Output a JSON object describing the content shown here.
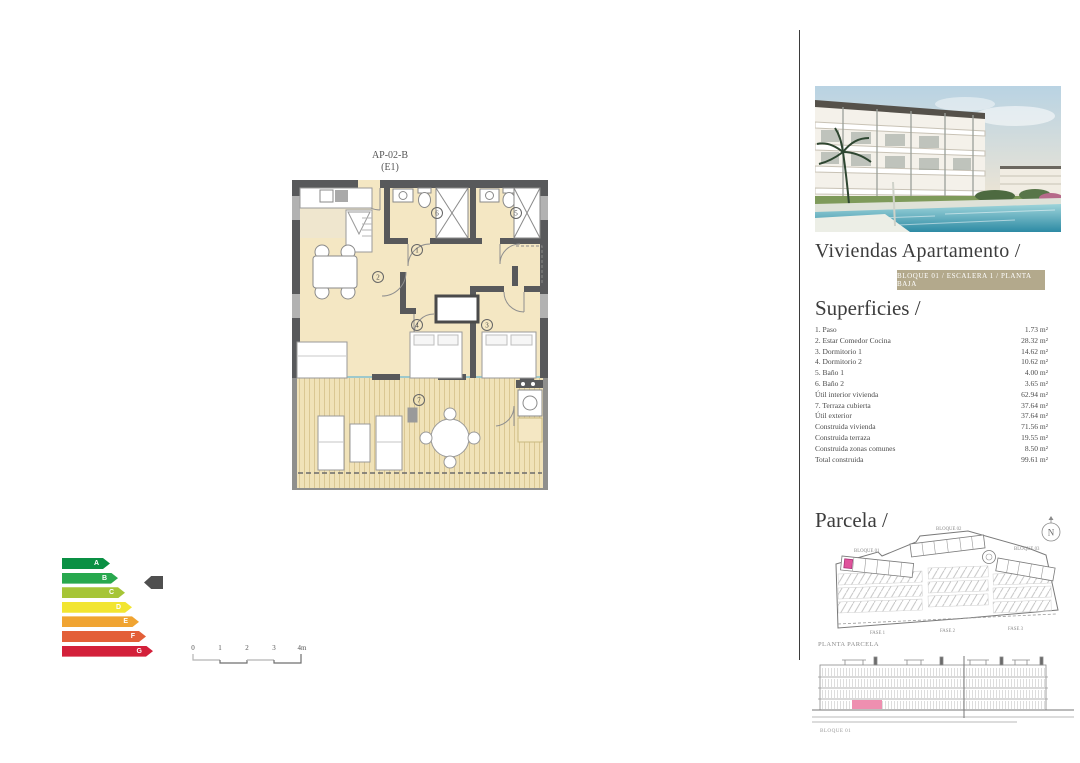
{
  "floorplan": {
    "title": "AP-02-B",
    "subtitle": "(E1)",
    "rooms": [
      "1",
      "2",
      "3",
      "4",
      "5",
      "6",
      "7"
    ]
  },
  "energy": {
    "ratings": [
      {
        "label": "A",
        "color": "#0a9044"
      },
      {
        "label": "B",
        "color": "#28a84e"
      },
      {
        "label": "C",
        "color": "#a6c537"
      },
      {
        "label": "D",
        "color": "#f2e531"
      },
      {
        "label": "E",
        "color": "#f0a432"
      },
      {
        "label": "F",
        "color": "#e35f38"
      },
      {
        "label": "G",
        "color": "#d3203a"
      }
    ],
    "selected": "B",
    "pointer_color": "#4f4f4f"
  },
  "scale_bar": {
    "ticks": [
      "0",
      "1",
      "2",
      "3",
      "4m"
    ]
  },
  "right_panel": {
    "title": "Viviendas Apartamento /",
    "badge": "BLOQUE 01 / ESCALERA 1 / PLANTA BAJA",
    "superficies_heading": "Superficies /",
    "superficies_rows": [
      {
        "label": "1. Paso",
        "value": "1.73 m²"
      },
      {
        "label": "2. Estar Comedor Cocina",
        "value": "28.32 m²"
      },
      {
        "label": "3. Dormitorio 1",
        "value": "14.62 m²"
      },
      {
        "label": "4. Dormitorio 2",
        "value": "10.62 m²"
      },
      {
        "label": "5. Baño 1",
        "value": "4.00 m²"
      },
      {
        "label": "6. Baño 2",
        "value": "3.65 m²"
      },
      {
        "label": "Útil interior vivienda",
        "value": "62.94 m²"
      },
      {
        "label": "7. Terraza cubierta",
        "value": "37.64 m²"
      },
      {
        "label": "Útil exterior",
        "value": "37.64 m²"
      },
      {
        "label": "Construida vivienda",
        "value": "71.56 m²"
      },
      {
        "label": "Construida terraza",
        "value": "19.55 m²"
      },
      {
        "label": "Construida zonas comunes",
        "value": "8.50 m²"
      },
      {
        "label": "Total construida",
        "value": "99.61 m²"
      }
    ],
    "parcela_heading": "Parcela /",
    "parcela": {
      "block_labels": [
        "BLOQUE 01",
        "BLOQUE 02",
        "BLOQUE 03"
      ],
      "fase_labels": [
        "FASE 1",
        "FASE 2",
        "FASE 3"
      ],
      "caption": "PLANTA PARCELA",
      "north_label": "N",
      "highlight_color": "#e0529b"
    },
    "elevation": {
      "caption": "BLOQUE 01",
      "highlight_color": "#ee8fb0"
    }
  },
  "colors": {
    "badge_bg": "#b3a98c",
    "floor": "#f4e7c3",
    "terrace": "#f0e2b8",
    "wall": "#58595b",
    "highlight_pink": "#e0529b"
  }
}
